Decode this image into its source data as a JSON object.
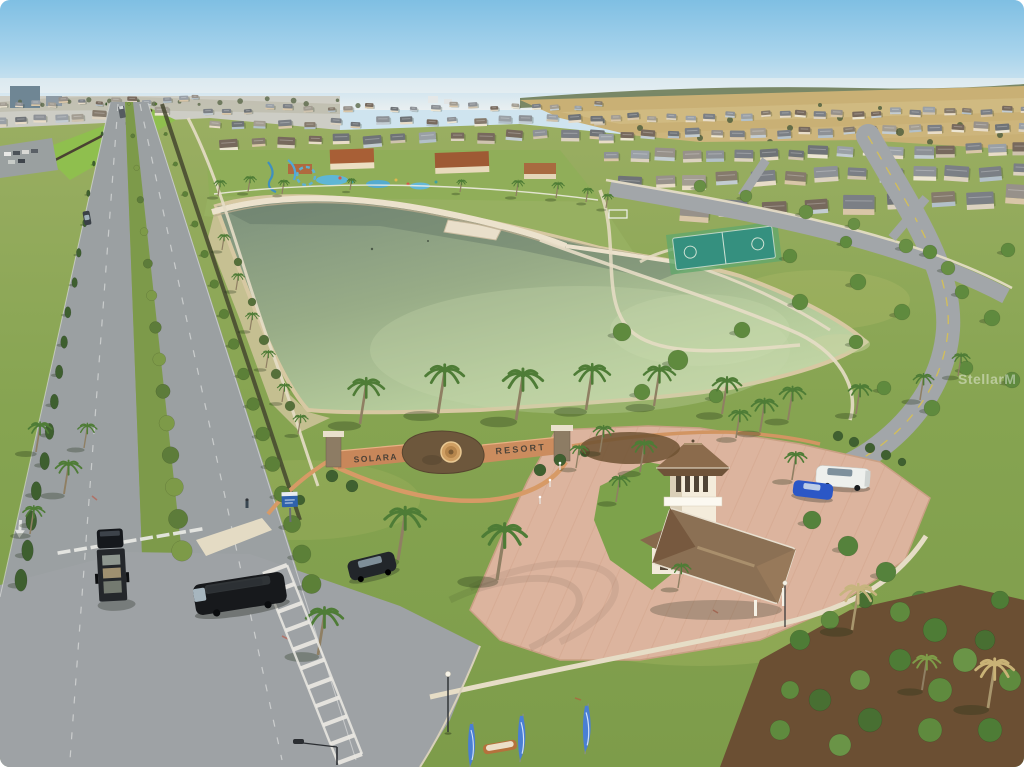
{
  "scene": {
    "community_sign": {
      "left_wall": "SOLARA",
      "right_wall": "RESORT"
    },
    "watermark": "StellarM",
    "colors": {
      "sky": "#7fbfe3",
      "lake_water": "#a7bd92",
      "grass": "#86a452",
      "asphalt_road": "#9ba0a2",
      "paver_plaza": "#dcb49e",
      "gatehouse_roof": "#8b6f50",
      "entrance_wall": "#c8875a",
      "flag_blue": "#4a7fd4"
    }
  }
}
